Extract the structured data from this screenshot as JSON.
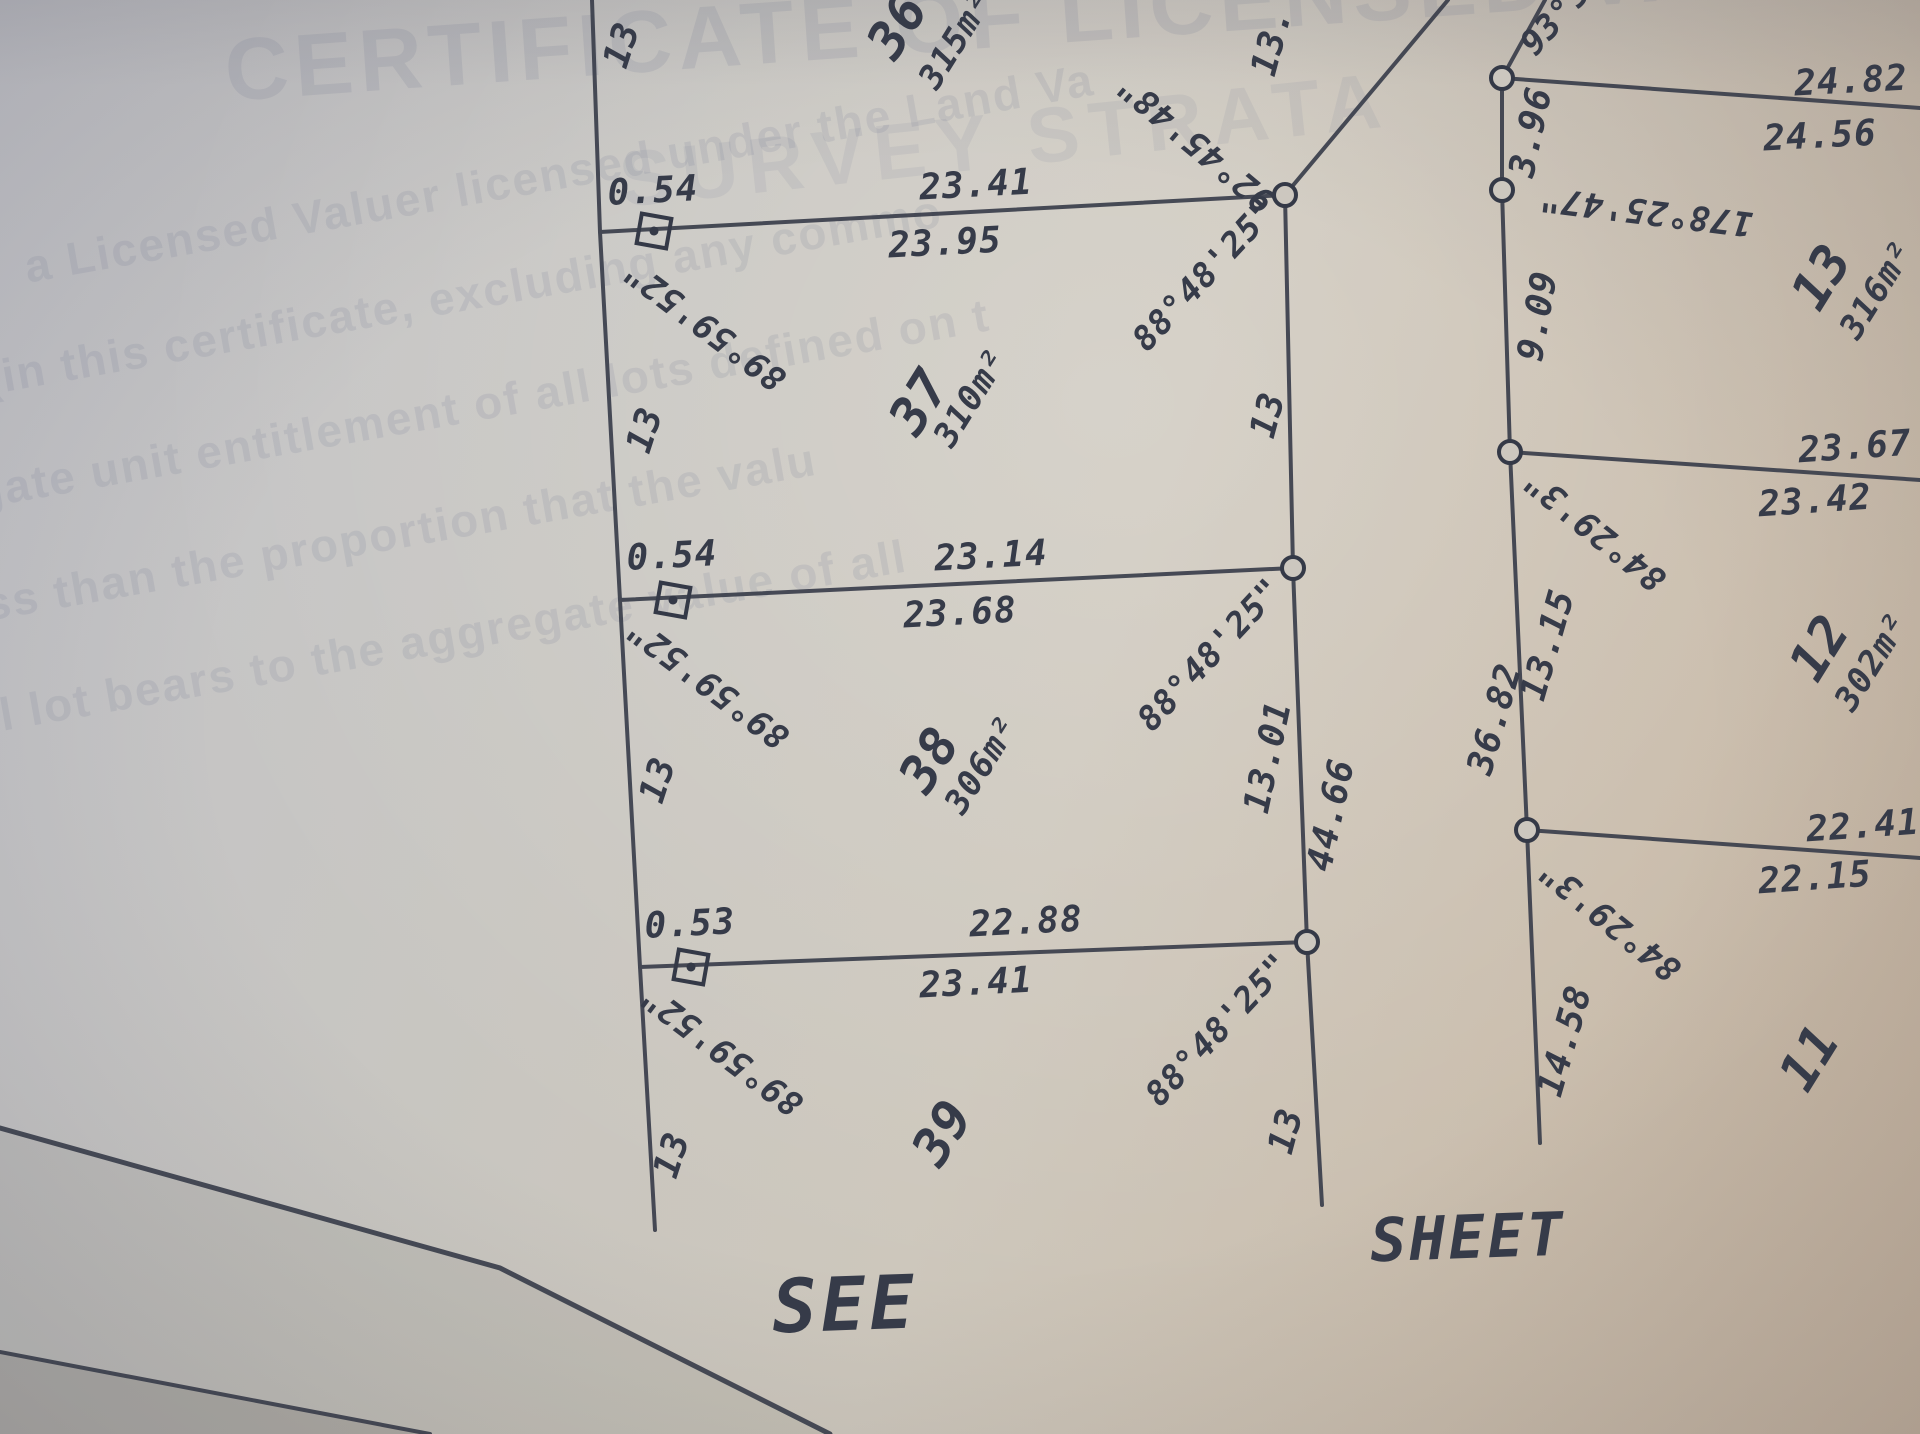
{
  "watermark": {
    "heading": "CERTIFICATE OF LICENSED VALUER",
    "heading2": "SURVEY STRATA",
    "body": [
      "a Licensed Valuer licensed under the Land Va",
      "(in this certificate, excluding any commo",
      "gate unit entitlement of all lots defined on t",
      "ss than the proportion that the valu",
      "l lot bears to the aggregate value of all"
    ]
  },
  "footer": {
    "see": "SEE",
    "sheet": "SHEET"
  },
  "left_strip": {
    "lots": [
      {
        "number": "36",
        "area": "315m²",
        "west_len": "13",
        "east_len": "13.",
        "east_bearing": "92°45'48\""
      },
      {
        "number": "37",
        "area": "310m²",
        "west_len": "13",
        "east_len": "13",
        "east_bearing": "88°48'25\""
      },
      {
        "number": "38",
        "area": "306m²",
        "west_len": "13",
        "east_len": "13.01",
        "east_bearing": "88°48'25\""
      },
      {
        "number": "39",
        "west_len": "13",
        "east_len": "13",
        "east_bearing": "88°48'25\""
      }
    ],
    "east_total": "44.66",
    "cross_lines": [
      {
        "offset": "0.54",
        "front": "23.41",
        "rear": "23.95",
        "bearing": "89°59'52\""
      },
      {
        "offset": "0.54",
        "front": "23.14",
        "rear": "23.68",
        "bearing": "89°59'52\""
      },
      {
        "offset": "0.53",
        "front": "22.88",
        "rear": "23.41",
        "bearing": "89°59'52\""
      }
    ]
  },
  "right_block": {
    "top_bearing": "93°5",
    "west_edges": [
      {
        "len": "3.96",
        "bearing": "178°25'47\""
      },
      {
        "len": "9.09"
      },
      {
        "len": "13.15",
        "bearing": "84°29'3\""
      },
      {
        "len": "36.82"
      },
      {
        "len": "14.58",
        "bearing": "84°29'3\""
      }
    ],
    "lots": [
      {
        "number": "13",
        "area": "316m²",
        "front": "24.82",
        "rear": "24.56"
      },
      {
        "number": "12",
        "area": "302m²",
        "front": "23.67",
        "rear": "23.42"
      },
      {
        "number": "11",
        "front": "22.41",
        "rear": "22.15"
      }
    ]
  }
}
